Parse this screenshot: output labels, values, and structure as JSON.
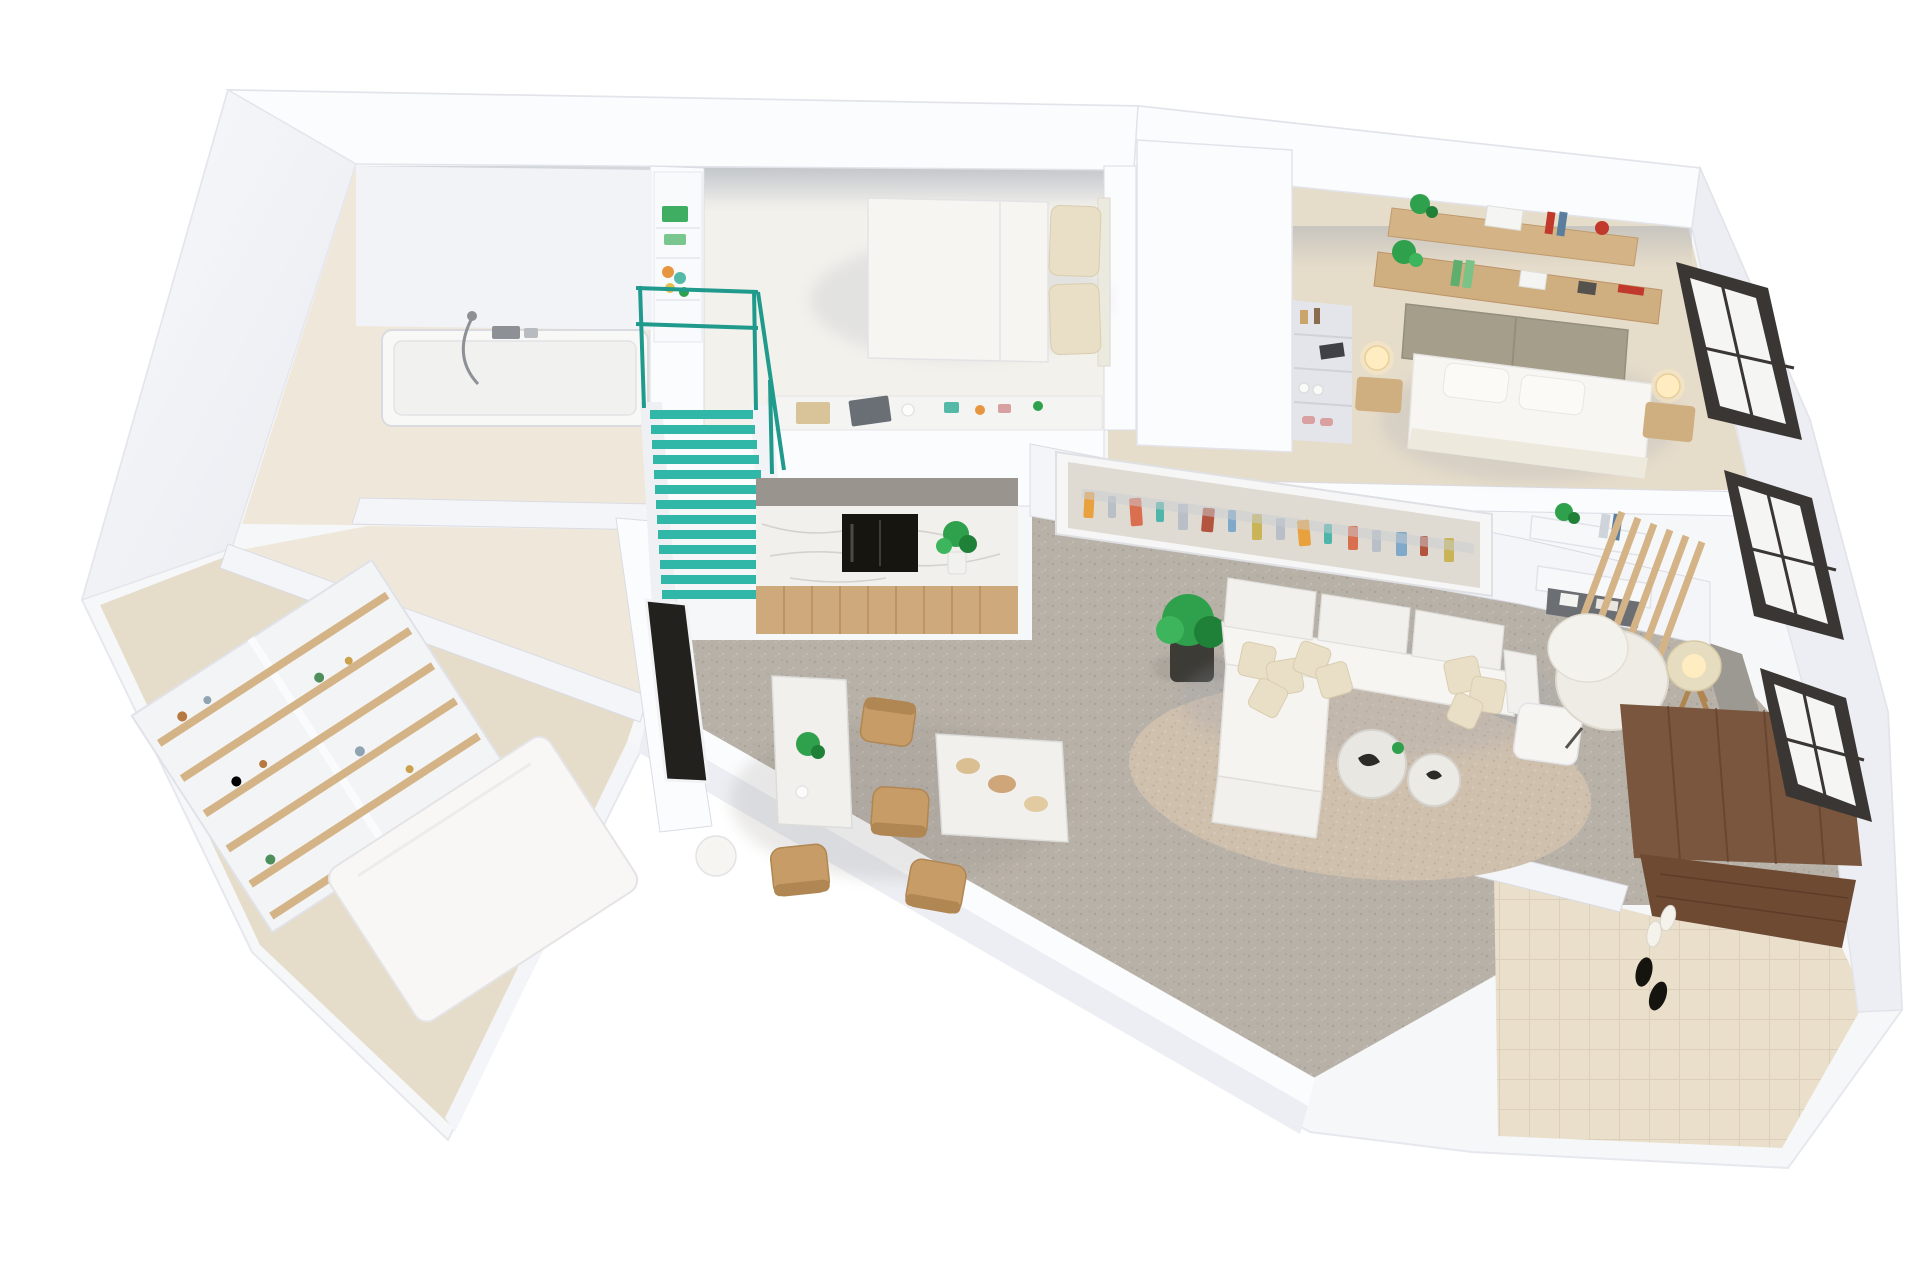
{
  "meta": {
    "title": "3D apartment floor plan render",
    "view": "isometric top-down 3D render",
    "background": "#ffffff"
  },
  "colors": {
    "floor_beige": "#e6dcca",
    "floor_beige_light": "#efe8da",
    "floor_tile": "#eadfcb",
    "tile_line": "#ddd0ba",
    "floor_concrete": "#b8b1a8",
    "concrete_fleck_dark": "#a8a198",
    "concrete_fleck_light": "#c6bfb5",
    "rug": "#cfc0ae",
    "rug_fleck": "#bfae9a",
    "stairs_teal": "#30b7a7",
    "stairs_teal_dark": "#1f9a8d",
    "wood_shelf": "#d4b487",
    "wood_desk": "#cfae80",
    "wood_cabinet": "#cda97b",
    "wood_plank_line": "#b98f60",
    "wood_chair": "#c89c66",
    "wood_dark": "#6f4a33",
    "wood_dark_line": "#5d3c28",
    "entry_wood_wall": "#7a563e",
    "marble": "#f1f0ed",
    "marble_vein": "#c9c6c2",
    "counter_band": "#99948d",
    "appliance_black": "#171510",
    "tv_black": "#23211d",
    "headboard_olive": "#a49e8b",
    "pillow_cream": "#e9dfc6",
    "plant_green": "#2fa04b",
    "plant_green_dark": "#1f8038",
    "plant_green_light": "#3db55c",
    "pot_black": "#3c3b36",
    "lamp_glow": "#ffecc0",
    "lamp_shade": "#e6dcc0",
    "lamp_wood": "#b0854f",
    "window_frame": "#3a3633",
    "chrome": "#8d9196",
    "terrace_gray": "#9c9892",
    "shoe_black": "#16140f",
    "decor_orange": "#e8953f",
    "decor_teal": "#55b9a8",
    "decor_yellow": "#e3c04b",
    "decor_green": "#3fae62",
    "decor_green_light": "#7ac68f",
    "decor_red": "#c0392b",
    "decor_pink": "#d8a0a0",
    "book_blue": "#5a7f9e",
    "book_green": "#5fae6e",
    "book_green_light": "#7bc286",
    "art": [
      "#e8a13c",
      "#d96f4e",
      "#4fb5a8",
      "#b3543f",
      "#7fa8c9",
      "#c9b458"
    ]
  },
  "rooms": [
    {
      "id": "bathroom",
      "label": "Bathroom",
      "furniture": [
        "bathtub",
        "shower-hose",
        "mixer-tap"
      ]
    },
    {
      "id": "loft-bedroom",
      "label": "Loft bedroom",
      "furniture": [
        "double-bed",
        "cream-pillows",
        "display-ledge",
        "decor-objects",
        "toy-shelf-column"
      ]
    },
    {
      "id": "staircase",
      "label": "Staircase",
      "furniture": [
        "teal-stairs",
        "teal-railing"
      ]
    },
    {
      "id": "kitchen",
      "label": "Kitchen",
      "furniture": [
        "marble-backsplash",
        "built-in-oven",
        "wood-cabinets",
        "counter-plant"
      ]
    },
    {
      "id": "dining",
      "label": "Dining area",
      "furniture": [
        "marble-table",
        "marble-side-table",
        "wood-chairs",
        "serving-bowls",
        "table-plant",
        "white-stool",
        "tv-panel"
      ]
    },
    {
      "id": "living",
      "label": "Living room",
      "furniture": [
        "sectional-sofa",
        "cream-cushions",
        "panoramic-wall-art",
        "floating-shelves",
        "wood-slat-partition",
        "armchair",
        "ottoman",
        "tripod-floor-lamp",
        "round-coffee-tables",
        "area-rug",
        "potted-plant"
      ]
    },
    {
      "id": "master-bedroom",
      "label": "Master bedroom",
      "furniture": [
        "upholstered-bed",
        "white-pillows",
        "nightstands",
        "glowing-bedside-lamps",
        "wood-wall-shelves",
        "desk-shelf",
        "plants",
        "books"
      ]
    },
    {
      "id": "walk-in-closet",
      "label": "Walk-in closet",
      "furniture": [
        "niche-shelves",
        "perfume-bottles",
        "shoes",
        "decor"
      ]
    },
    {
      "id": "wardrobe-room",
      "label": "Wardrobe room",
      "furniture": [
        "wood-shelving-unit",
        "vases",
        "guest-mattress"
      ]
    },
    {
      "id": "entry",
      "label": "Entry hall",
      "furniture": [
        "dark-wood-floor",
        "wood-wardrobe-wall",
        "shoes"
      ]
    }
  ],
  "windows": {
    "count": 3,
    "frame_style": "dark aluminum"
  }
}
